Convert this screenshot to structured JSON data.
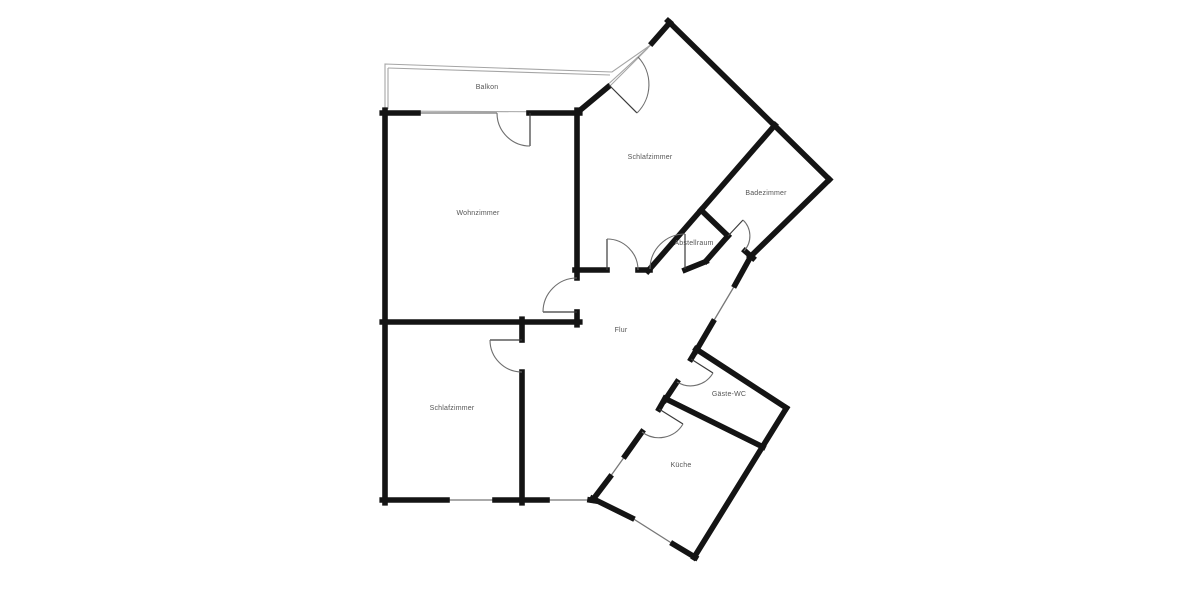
{
  "plan": {
    "title": "Grundriss",
    "colors": {
      "bg": "#ffffff",
      "wall": "#141414",
      "thin": "#777777",
      "balcony": "#a5a5a5",
      "label": "#555555"
    },
    "rooms": [
      {
        "id": "balkon",
        "label": "Balkon",
        "x": 487,
        "y": 89
      },
      {
        "id": "wohnzimmer",
        "label": "Wohnzimmer",
        "x": 478,
        "y": 215
      },
      {
        "id": "schlafzimmer-1",
        "label": "Schlafzimmer",
        "x": 650,
        "y": 159
      },
      {
        "id": "badezimmer",
        "label": "Badezimmer",
        "x": 766,
        "y": 195
      },
      {
        "id": "abstellraum",
        "label": "Abstellraum",
        "x": 694,
        "y": 245
      },
      {
        "id": "flur",
        "label": "Flur",
        "x": 621,
        "y": 332
      },
      {
        "id": "gaeste-wc",
        "label": "Gäste-WC",
        "x": 729,
        "y": 396
      },
      {
        "id": "kueche",
        "label": "Küche",
        "x": 681,
        "y": 467
      },
      {
        "id": "schlafzimmer-2",
        "label": "Schlafzimmer",
        "x": 452,
        "y": 410
      }
    ]
  }
}
